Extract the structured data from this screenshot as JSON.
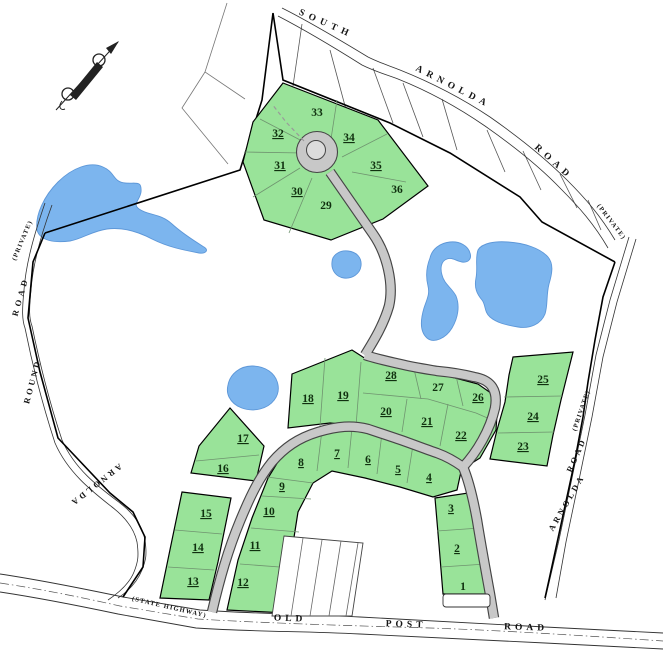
{
  "map": {
    "roads": {
      "south_arnolda": {
        "w1": "SOUTH",
        "w2": "ARNOLDA",
        "w3": "ROAD",
        "suffix": "(PRIVATE)"
      },
      "arnolda_round": {
        "w1": "ARNOLDA",
        "w2": "ROUND",
        "w3": "ROAD",
        "suffix": "(PRIVATE)"
      },
      "arnolda_east": {
        "w1": "ARNOLDA",
        "w2": "ROAD",
        "suffix": "(PRIVATE)"
      },
      "old_post": {
        "w1": "OLD",
        "w2": "POST",
        "w3": "ROAD",
        "prefix": "(STATE HIGHWAY)"
      }
    },
    "lots": [
      {
        "n": "1",
        "u": false
      },
      {
        "n": "2",
        "u": true
      },
      {
        "n": "3",
        "u": true
      },
      {
        "n": "4",
        "u": true
      },
      {
        "n": "5",
        "u": true
      },
      {
        "n": "6",
        "u": true
      },
      {
        "n": "7",
        "u": true
      },
      {
        "n": "8",
        "u": true
      },
      {
        "n": "9",
        "u": true
      },
      {
        "n": "10",
        "u": true
      },
      {
        "n": "11",
        "u": true
      },
      {
        "n": "12",
        "u": true
      },
      {
        "n": "13",
        "u": true
      },
      {
        "n": "14",
        "u": true
      },
      {
        "n": "15",
        "u": true
      },
      {
        "n": "16",
        "u": true
      },
      {
        "n": "17",
        "u": true
      },
      {
        "n": "18",
        "u": true
      },
      {
        "n": "19",
        "u": true
      },
      {
        "n": "20",
        "u": true
      },
      {
        "n": "21",
        "u": true
      },
      {
        "n": "22",
        "u": true
      },
      {
        "n": "23",
        "u": true
      },
      {
        "n": "24",
        "u": true
      },
      {
        "n": "25",
        "u": true
      },
      {
        "n": "26",
        "u": true
      },
      {
        "n": "27",
        "u": false
      },
      {
        "n": "28",
        "u": true
      },
      {
        "n": "29",
        "u": false
      },
      {
        "n": "30",
        "u": true
      },
      {
        "n": "31",
        "u": true
      },
      {
        "n": "32",
        "u": true
      },
      {
        "n": "33",
        "u": false
      },
      {
        "n": "34",
        "u": true
      },
      {
        "n": "35",
        "u": true
      },
      {
        "n": "36",
        "u": false
      }
    ],
    "icons": {
      "compass": "north-arrow"
    },
    "colors": {
      "lot_green": "#99e399",
      "water_blue": "#7cb5ee",
      "road_gray": "#c8c8c8"
    }
  }
}
